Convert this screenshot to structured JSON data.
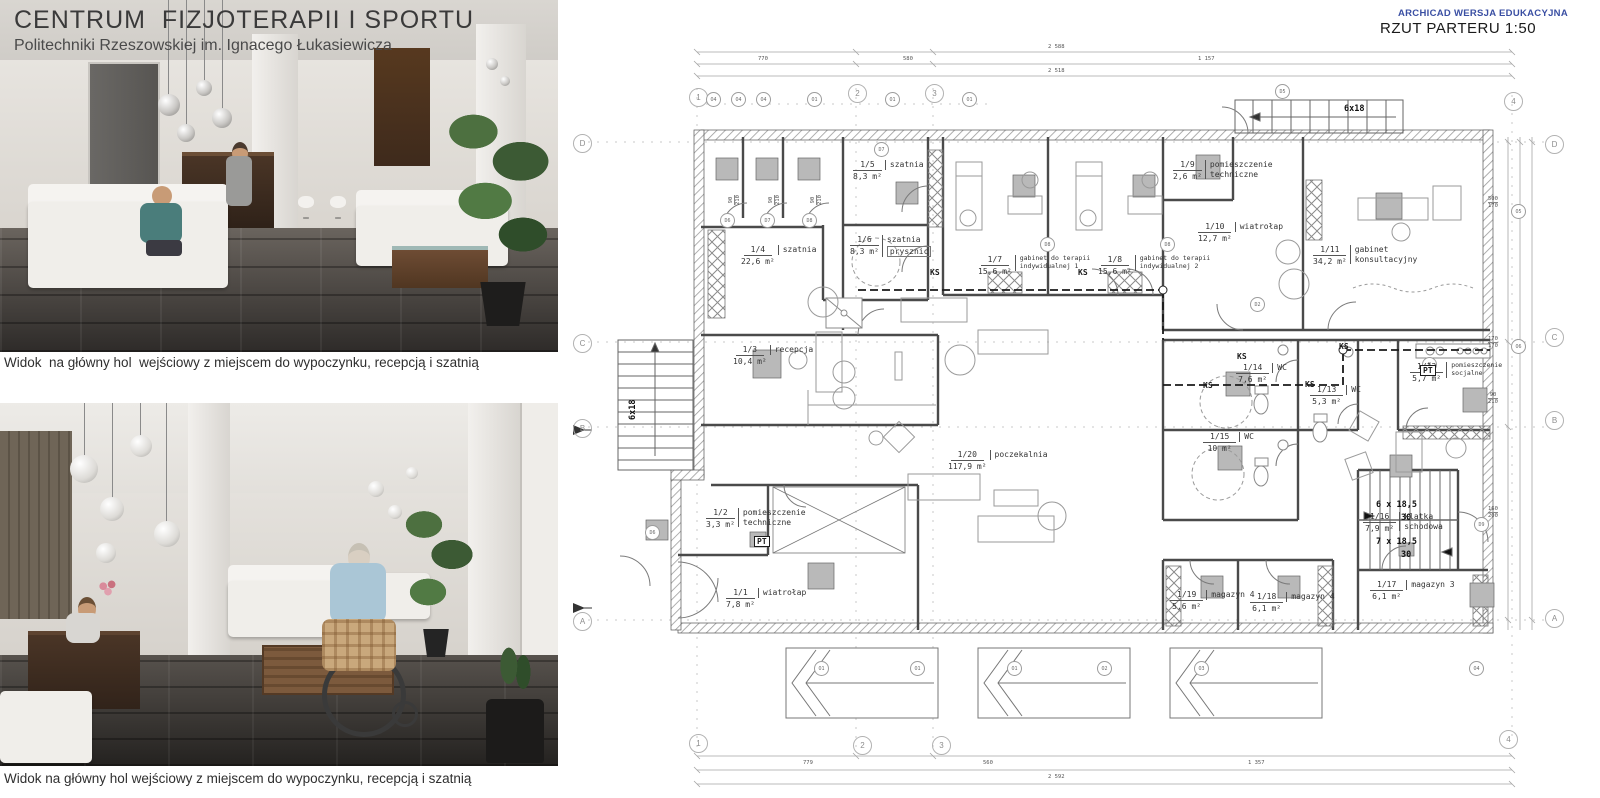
{
  "header": {
    "title": "CENTRUM  FIZJOTERAPII I SPORTU",
    "subtitle": "Politechniki Rzeszowskiej im. Ignacego Łukasiewicza"
  },
  "captions": {
    "top": "Widok  na główny hol  wejściowy z miejscem do wypoczynku, recepcją i szatnią",
    "bottom": "Widok na główny hol wejściowy z miejscem do wypoczynku, recepcją i szatnią"
  },
  "plan": {
    "watermark": "ARCHICAD WERSJA EDUKACYJNA",
    "title": "RZUT PARTERU 1:50",
    "rooms": [
      {
        "id": "1/1",
        "area": "7,8 m²",
        "name": "wiatrołap"
      },
      {
        "id": "1/2",
        "area": "3,3 m²",
        "name": "pomieszczenie",
        "name2": "techniczne"
      },
      {
        "id": "1/3",
        "area": "10,4 m²",
        "name": "recepcja"
      },
      {
        "id": "1/4",
        "area": "22,6 m²",
        "name": "szatnia"
      },
      {
        "id": "1/5",
        "area": "8,3 m²",
        "name": "szatnia"
      },
      {
        "id": "1/6",
        "area": "8,3 m²",
        "name": "szatnia",
        "extra": "prysznic"
      },
      {
        "id": "1/7",
        "area": "15,6 m²",
        "name": "gabinet do terapii",
        "name2": "indywidualnej 1"
      },
      {
        "id": "1/8",
        "area": "15,6 m²",
        "name": "gabinet do terapii",
        "name2": "indywidualnej 2"
      },
      {
        "id": "1/9",
        "area": "2,6 m²",
        "name": "pomieszczenie",
        "name2": "techniczne"
      },
      {
        "id": "1/10",
        "area": "12,7 m²",
        "name": "wiatrołap"
      },
      {
        "id": "1/11",
        "area": "34,2 m²",
        "name": "gabinet",
        "name2": "konsultacyjny"
      },
      {
        "id": "1/12",
        "area": "5,7 m²",
        "name": "pomieszczenie",
        "name2": "socjalne"
      },
      {
        "id": "1/13",
        "area": "5,3 m²",
        "name": "WC"
      },
      {
        "id": "1/14",
        "area": "7,6 m²",
        "name": "WC"
      },
      {
        "id": "1/15",
        "area": "10 m²",
        "name": "WC"
      },
      {
        "id": "1/16",
        "area": "7,9 m²",
        "name": "klatka",
        "name2": "schodowa"
      },
      {
        "id": "1/17",
        "area": "6,1 m²",
        "name": "magazyn 3"
      },
      {
        "id": "1/18",
        "area": "6,1 m²",
        "name": "magazyn 4"
      },
      {
        "id": "1/19",
        "area": "5,6 m²",
        "name": "magazyn 4"
      },
      {
        "id": "1/20",
        "area": "117,9 m²",
        "name": "poczekalnia"
      }
    ],
    "annotations": {
      "ks": "KS",
      "pt": "PT",
      "stair_top": "6x18",
      "stair_left": "6x18",
      "stair_run1": "6 x 18,5",
      "stair_rise1": "30",
      "stair_run2": "7 x 18,5",
      "stair_rise2": "30"
    },
    "grid": {
      "cols": [
        "1",
        "2",
        "3",
        "4"
      ],
      "rows": [
        "D",
        "C",
        "B",
        "A"
      ]
    },
    "markers": [
      "D6",
      "D7",
      "D8",
      "D7",
      "D8",
      "D8",
      "D5",
      "D2",
      "D9",
      "D6",
      "O4",
      "O4",
      "O4",
      "O1",
      "O1",
      "O1",
      "O1",
      "O1",
      "O1",
      "O2",
      "O3",
      "O4",
      "O5",
      "O6",
      "B"
    ],
    "dims": {
      "top_total": "2 588",
      "top_row": [
        "770",
        "580",
        "1 157"
      ],
      "top_row2": "2 518",
      "bottom_row": [
        "779",
        "560",
        "1 357"
      ],
      "bottom_total": "2 592",
      "right_pairs": [
        [
          "500",
          "170"
        ],
        [
          "170",
          "170"
        ],
        [
          "90",
          "210"
        ],
        [
          "160",
          "200"
        ]
      ]
    }
  },
  "colors": {
    "archicad_blue": "#3a4fa3",
    "ink": "#2f2f2f",
    "plan_line": "#4a4a4a",
    "gray_fill": "#b9b9b9",
    "floor_dark": "#35322f",
    "accent_teal": "#4a7d7b"
  }
}
